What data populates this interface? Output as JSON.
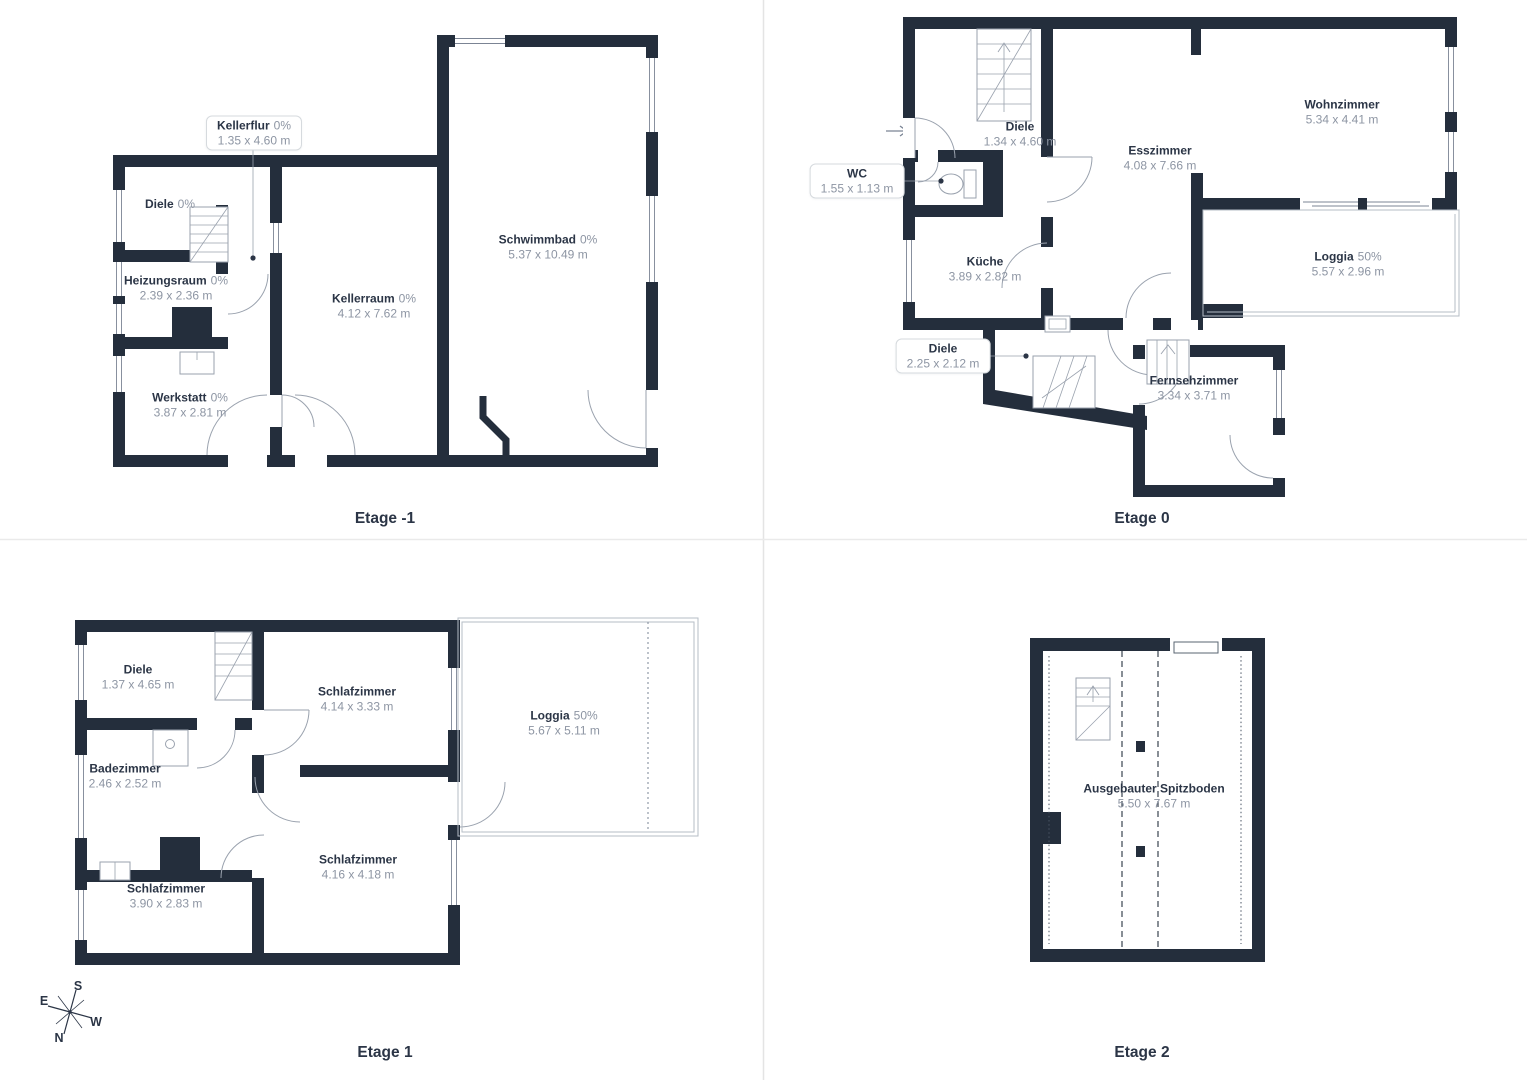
{
  "colors": {
    "wall": "#242e3c",
    "room_name_text": "#2b3546",
    "dim_text": "#8d95a3",
    "divider": "#e6e6e6",
    "door_line": "#9aa2ae",
    "thin_wall": "#b5bcc6"
  },
  "floors": [
    {
      "title": "Etage -1",
      "rooms": [
        {
          "name": "Kellerflur",
          "pct": "0%",
          "dims": "1.35 x 4.60 m"
        },
        {
          "name": "Diele",
          "pct": "0%",
          "dims": ""
        },
        {
          "name": "Heizungsraum",
          "pct": "0%",
          "dims": "2.39 x 2.36 m"
        },
        {
          "name": "Kellerraum",
          "pct": "0%",
          "dims": "4.12 x 7.62 m"
        },
        {
          "name": "Schwimmbad",
          "pct": "0%",
          "dims": "5.37 x 10.49 m"
        },
        {
          "name": "Werkstatt",
          "pct": "0%",
          "dims": "3.87 x 2.81 m"
        }
      ]
    },
    {
      "title": "Etage 0",
      "rooms": [
        {
          "name": "Diele",
          "pct": "",
          "dims": "1.34 x 4.60 m"
        },
        {
          "name": "WC",
          "pct": "",
          "dims": "1.55 x 1.13 m"
        },
        {
          "name": "Esszimmer",
          "pct": "",
          "dims": "4.08 x 7.66 m"
        },
        {
          "name": "Wohnzimmer",
          "pct": "",
          "dims": "5.34 x 4.41 m"
        },
        {
          "name": "Loggia",
          "pct": "50%",
          "dims": "5.57 x 2.96 m"
        },
        {
          "name": "Küche",
          "pct": "",
          "dims": "3.89 x 2.82 m"
        },
        {
          "name": "Diele",
          "pct": "",
          "dims": "2.25 x 2.12 m"
        },
        {
          "name": "Fernsehzimmer",
          "pct": "",
          "dims": "3.34 x 3.71 m"
        }
      ]
    },
    {
      "title": "Etage 1",
      "rooms": [
        {
          "name": "Diele",
          "pct": "",
          "dims": "1.37 x 4.65 m"
        },
        {
          "name": "Schlafzimmer",
          "pct": "",
          "dims": "4.14 x 3.33 m"
        },
        {
          "name": "Badezimmer",
          "pct": "",
          "dims": "2.46 x 2.52 m"
        },
        {
          "name": "Loggia",
          "pct": "50%",
          "dims": "5.67 x 5.11 m"
        },
        {
          "name": "Schlafzimmer",
          "pct": "",
          "dims": "4.16 x 4.18 m"
        },
        {
          "name": "Schlafzimmer",
          "pct": "",
          "dims": "3.90 x 2.83 m"
        }
      ]
    },
    {
      "title": "Etage 2",
      "rooms": [
        {
          "name": "Ausgebauter Spitzboden",
          "pct": "",
          "dims": "5.50 x 7.67 m"
        }
      ]
    }
  ],
  "compass": {
    "n": "N",
    "e": "E",
    "s": "S",
    "w": "W"
  }
}
